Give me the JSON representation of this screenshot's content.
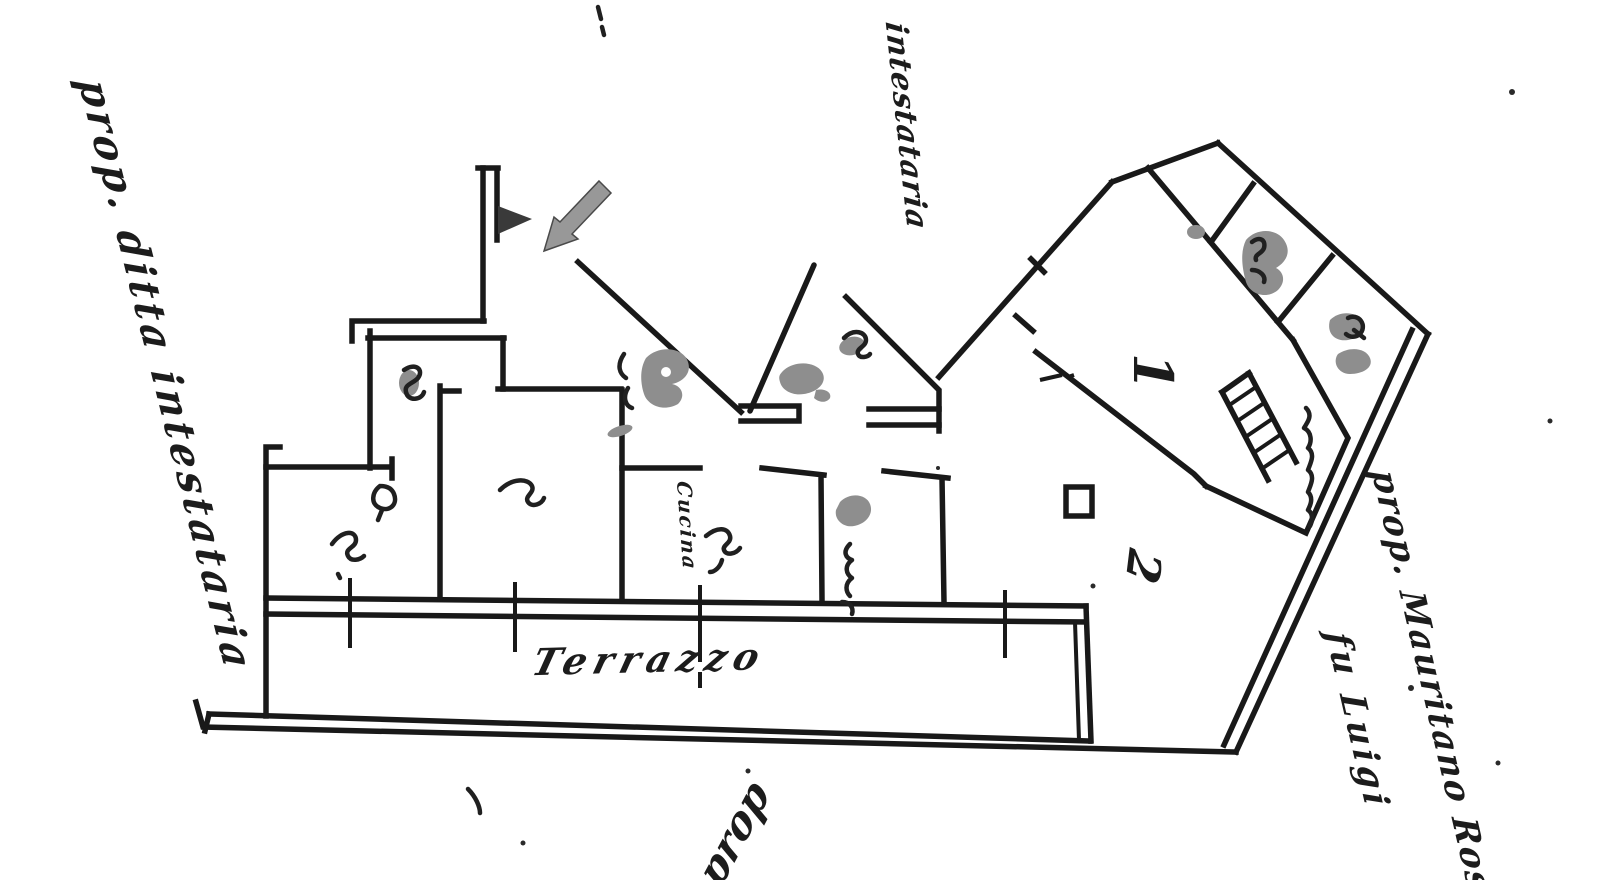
{
  "meta": {
    "description": "Scanned hand-drawn cadastral floor plan (planimetria), black ink on white paper with photocopy smudges",
    "background_color": "#ffffff",
    "ink_color": "#191919",
    "smudge_color": "#8e8e8e"
  },
  "annotations": {
    "owner_left": "prop. ditta intestataria",
    "owner_top": "intestataria",
    "owner_right_line1": "prop. Mauritano Rosa",
    "owner_right_line2": "fu Luigi",
    "owner_bottom_partial": "prop",
    "terrace_label": "Terrazzo",
    "kitchen_label": "Cucina",
    "room_number_1": "1",
    "room_number_2": "2"
  }
}
